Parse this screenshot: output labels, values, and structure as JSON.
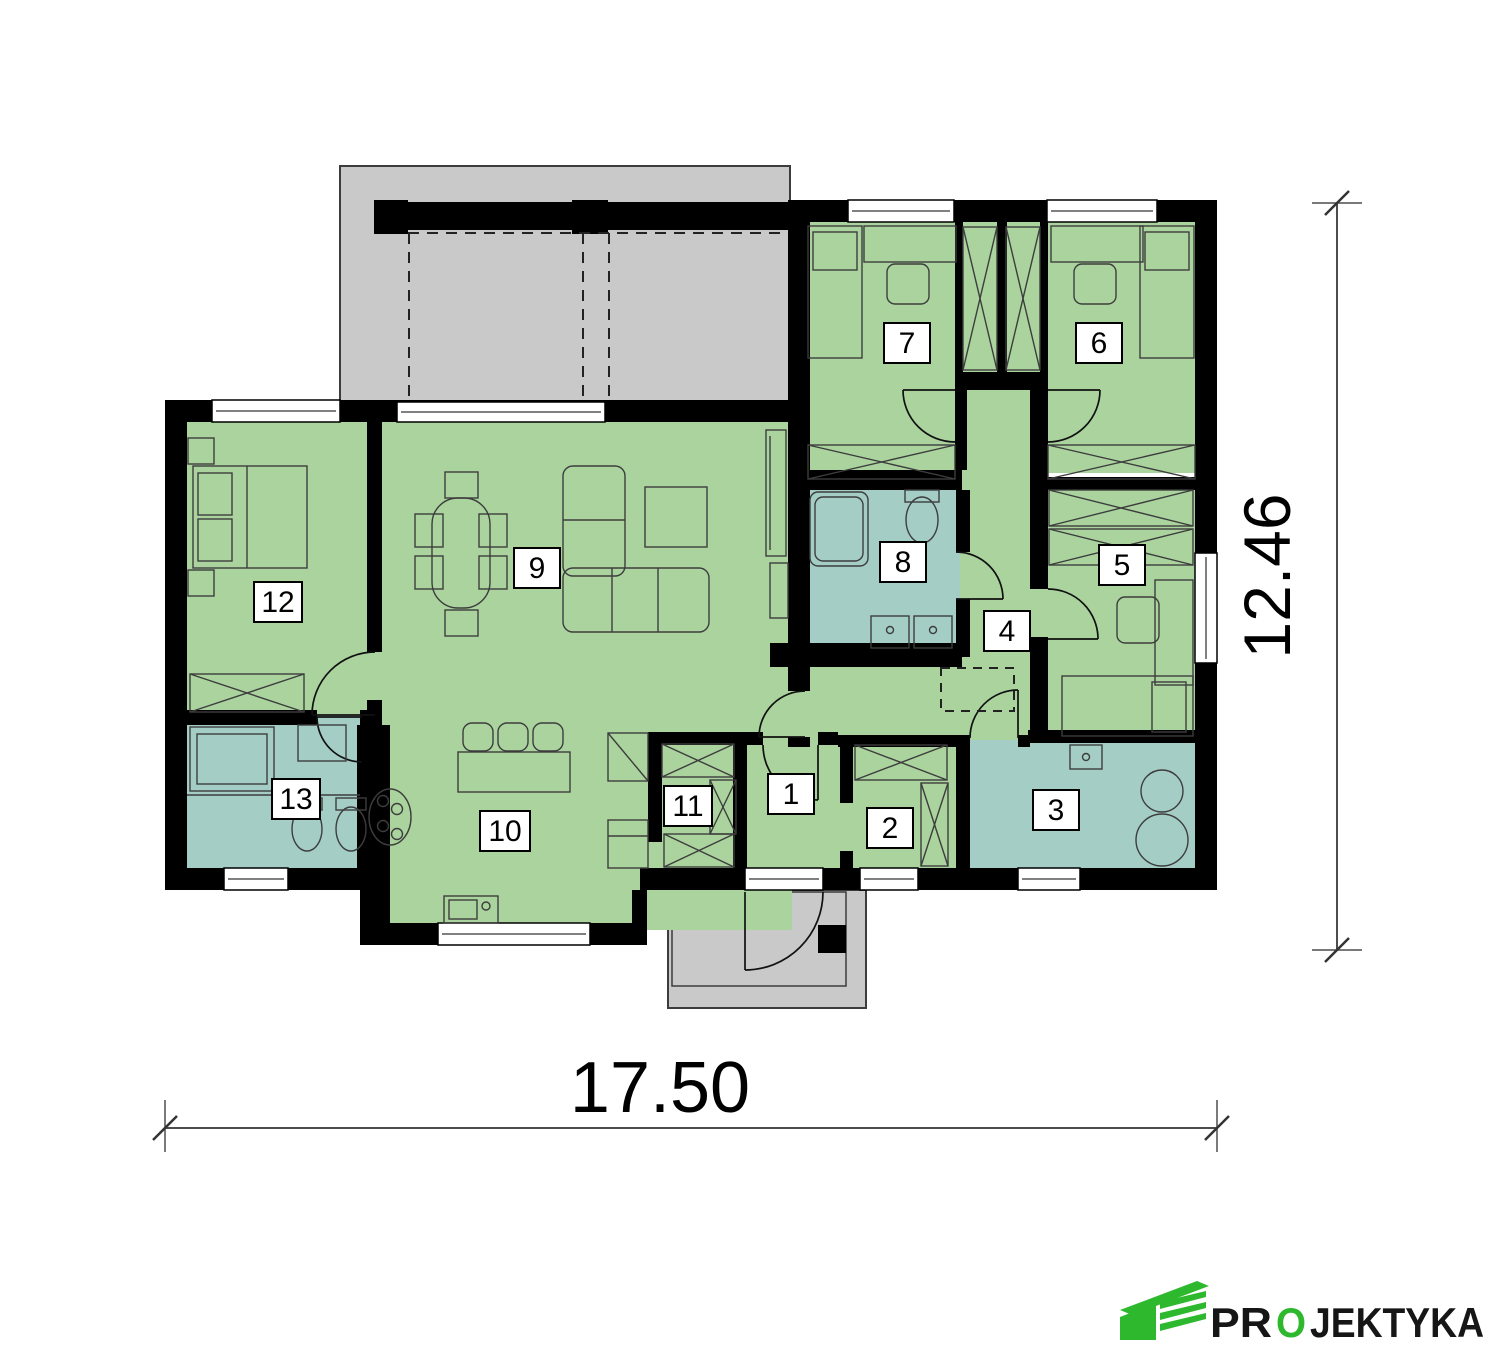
{
  "rooms": [
    {
      "label": "1"
    },
    {
      "label": "2"
    },
    {
      "label": "3"
    },
    {
      "label": "4"
    },
    {
      "label": "5"
    },
    {
      "label": "6"
    },
    {
      "label": "7"
    },
    {
      "label": "8"
    },
    {
      "label": "9"
    },
    {
      "label": "10"
    },
    {
      "label": "11"
    },
    {
      "label": "12"
    },
    {
      "label": "13"
    }
  ],
  "dimensions": {
    "width_label": "17.50",
    "height_label": "12.46"
  },
  "brand": {
    "name_pre": "PR",
    "name_accent": "O",
    "name_post": "JEKTYKA"
  },
  "colors": {
    "room_green": "#aad39e",
    "wet_room_teal": "#a4cdc5",
    "outdoor_gray": "#c9c9c9",
    "wall_black": "#000000",
    "brand_green": "#2eb82e",
    "brand_dark": "#161616"
  }
}
